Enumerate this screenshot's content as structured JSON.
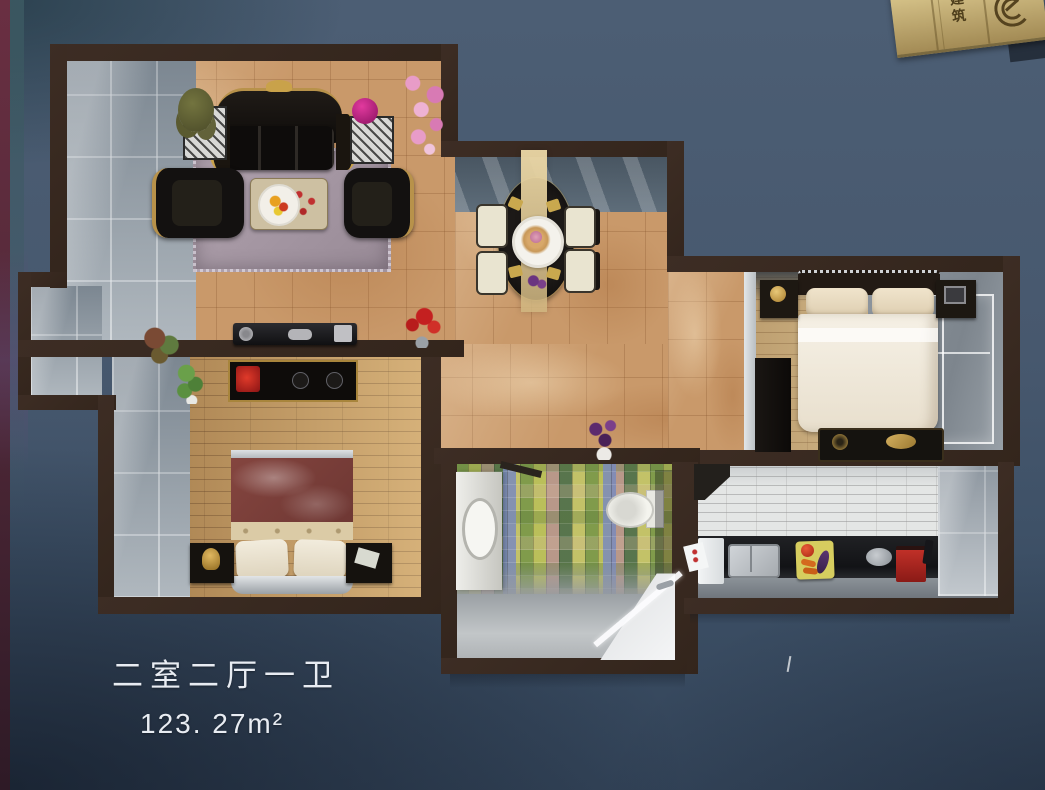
{
  "caption": {
    "layout_type": "二室二厅一卫",
    "area": "123. 27m²"
  },
  "plaque": {
    "vertical_text": "建筑",
    "logo": "concentric-arcs-logo"
  },
  "palette": {
    "backdrop_top": "#4c5e74",
    "backdrop_bottom": "#334459",
    "wall_brown": "#38291f",
    "tile_floor_tan": "#c9996a",
    "wood_floor": "#c49a60",
    "wood_floor_light": "#d2b584",
    "rug_gray_mauve": "#a495a2",
    "sofa_black": "#141210",
    "gold_trim": "#c9a24a",
    "bed_white": "#f2ece0",
    "duvet_maroon": "#7c3f3b",
    "mosaic_green": "#7e9a4a",
    "mosaic_blue": "#7a8abc",
    "kitchen_counter": "#17181a",
    "glass_gray": "#98a1a9",
    "plaque_brass": "#b89f63",
    "caption_white": "#e8ecf2"
  }
}
